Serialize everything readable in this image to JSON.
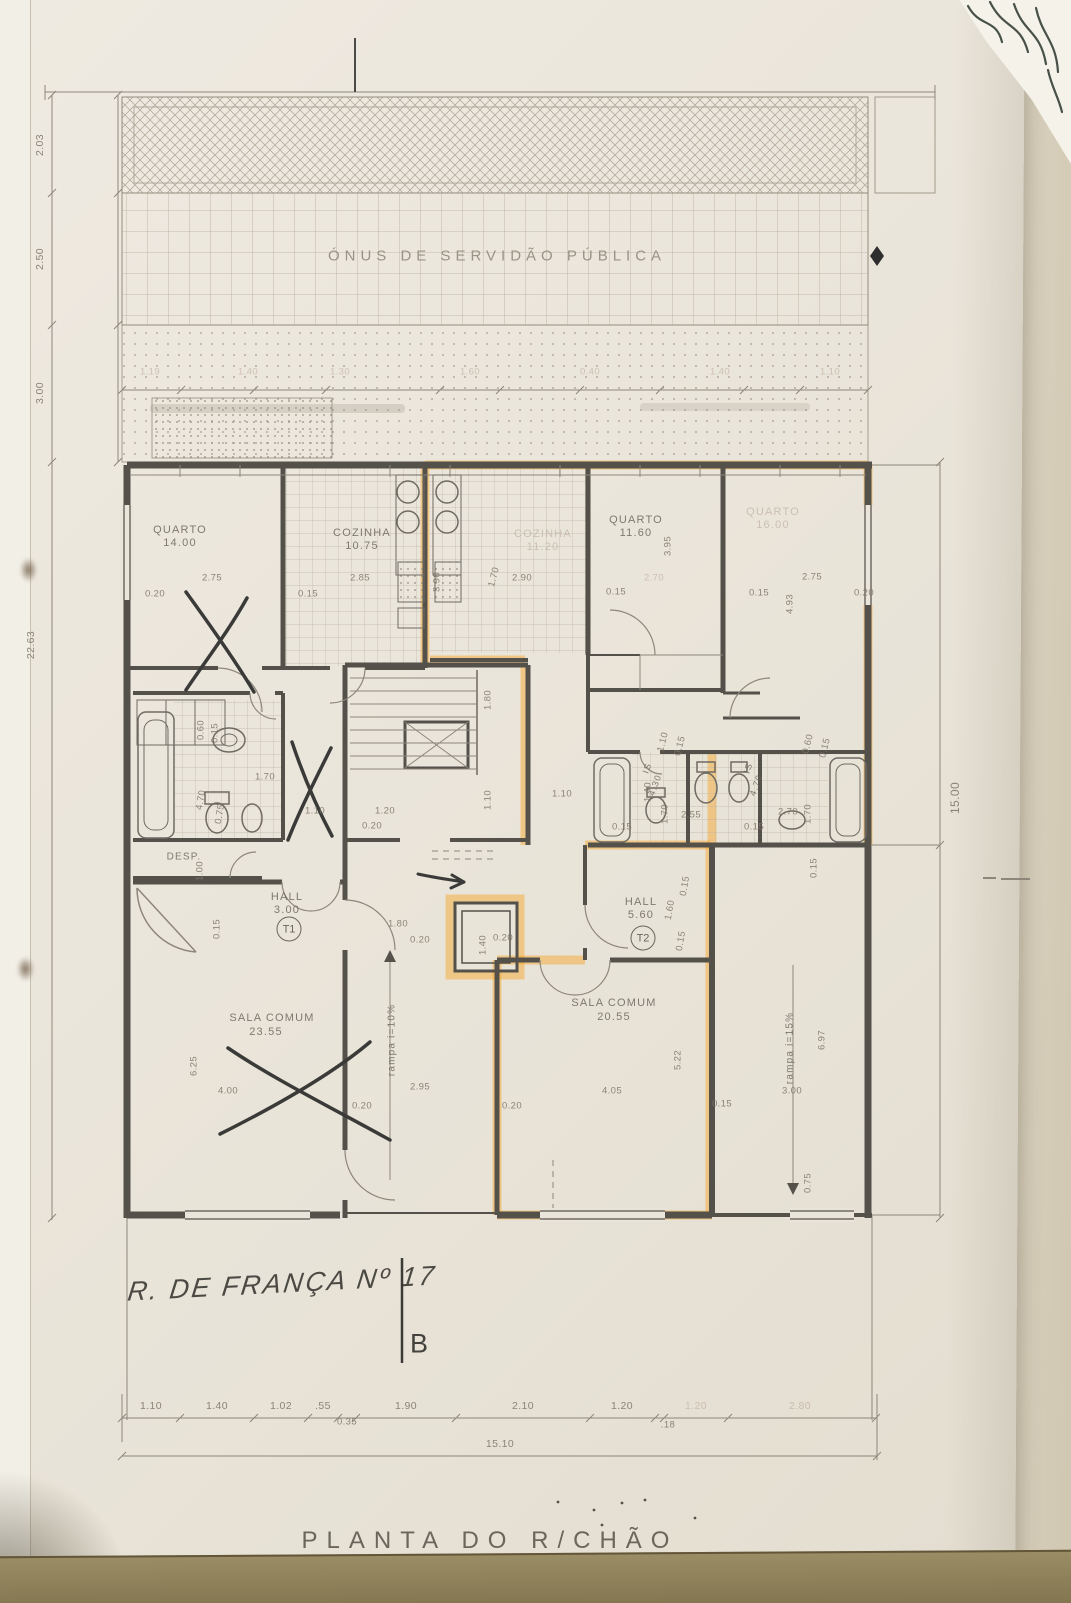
{
  "sheet": {
    "title": "PLANTA DO R/CHÃO",
    "easement_text": "ÓNUS DE SERVIDÃO PÚBLICA",
    "highlight_color": "#f2a731",
    "paper_color": "#eae5da",
    "table_color": "#8d7e59"
  },
  "handwriting": {
    "street": "R. DE FRANÇA Nº 17",
    "section_mark": "B"
  },
  "units": [
    {
      "tag": "T1"
    },
    {
      "tag": "T2"
    }
  ],
  "rooms": [
    {
      "name": "quarto-1",
      "label": "QUARTO",
      "area": "14.00"
    },
    {
      "name": "cozinha-1",
      "label": "COZINHA",
      "area": "10.75"
    },
    {
      "name": "cozinha-2",
      "label": "COZINHA",
      "area": "11.20"
    },
    {
      "name": "quarto-2",
      "label": "QUARTO",
      "area": "11.60"
    },
    {
      "name": "quarto-3",
      "label": "QUARTO",
      "area": "16.00"
    },
    {
      "name": "is-1",
      "label": "IS",
      "area": "4.30"
    },
    {
      "name": "is-2",
      "label": "IS",
      "area": "4.70"
    },
    {
      "name": "despensa",
      "label": "DESP."
    },
    {
      "name": "hall-t1",
      "label": "HALL",
      "area": "3.00"
    },
    {
      "name": "hall-t2",
      "label": "HALL",
      "area": "5.60"
    },
    {
      "name": "sala-comum-1",
      "label": "SALA COMUM",
      "area": "23.55"
    },
    {
      "name": "sala-comum-2",
      "label": "SALA COMUM",
      "area": "20.55"
    },
    {
      "name": "rampa-1",
      "label": "rampa i=10%"
    },
    {
      "name": "rampa-2",
      "label": "rampa i=15%"
    }
  ],
  "dimension_chains": {
    "left_vertical": [
      "2.03",
      "2.50",
      "3.00",
      "22.63"
    ],
    "right_vertical": [
      "15.00"
    ],
    "upper_row": [
      "1.19",
      "1.40",
      "1.30",
      "1.60",
      "0.40",
      "1.40",
      "1.10"
    ],
    "bottom_row": [
      "1.10",
      "1.40",
      "1.02",
      ".55",
      "1.90",
      "2.10",
      "1.20",
      "1.20",
      "2.80"
    ],
    "bottom_sub": [
      "0.35",
      ".18"
    ],
    "bottom_total": "15.10"
  },
  "labels": [
    {
      "n": "easement-text",
      "t": "ÓNUS DE SERVIDÃO PÚBLICA",
      "x": 497,
      "y": 256,
      "cls": "easement"
    },
    {
      "n": "room-quarto-1-label",
      "t": "QUARTO",
      "x": 180,
      "y": 530,
      "cls": "room"
    },
    {
      "n": "room-quarto-1-area",
      "t": "14.00",
      "x": 180,
      "y": 543,
      "cls": "room"
    },
    {
      "n": "room-cozinha-1-label",
      "t": "COZINHA",
      "x": 362,
      "y": 533,
      "cls": "room"
    },
    {
      "n": "room-cozinha-1-area",
      "t": "10.75",
      "x": 362,
      "y": 546,
      "cls": "room"
    },
    {
      "n": "room-cozinha-2-label",
      "t": "COZINHA",
      "x": 543,
      "y": 534,
      "cls": "room faint2"
    },
    {
      "n": "room-cozinha-2-area",
      "t": "11.20",
      "x": 543,
      "y": 547,
      "cls": "room faint2"
    },
    {
      "n": "room-quarto-2-label",
      "t": "QUARTO",
      "x": 636,
      "y": 520,
      "cls": "room"
    },
    {
      "n": "room-quarto-2-area",
      "t": "11.60",
      "x": 636,
      "y": 533,
      "cls": "room"
    },
    {
      "n": "room-quarto-3-label",
      "t": "QUARTO",
      "x": 773,
      "y": 512,
      "cls": "room faint2"
    },
    {
      "n": "room-quarto-3-area",
      "t": "16.00",
      "x": 773,
      "y": 525,
      "cls": "room faint2"
    },
    {
      "n": "room-desp-label",
      "t": "DESP.",
      "x": 184,
      "y": 857,
      "cls": "room",
      "fs": 10
    },
    {
      "n": "room-hall-t1-label",
      "t": "HALL",
      "x": 287,
      "y": 897,
      "cls": "room"
    },
    {
      "n": "room-hall-t1-area",
      "t": "3.00",
      "x": 287,
      "y": 910,
      "cls": "room"
    },
    {
      "n": "room-hall-t2-label",
      "t": "HALL",
      "x": 641,
      "y": 902,
      "cls": "room"
    },
    {
      "n": "room-hall-t2-area",
      "t": "5.60",
      "x": 641,
      "y": 915,
      "cls": "room"
    },
    {
      "n": "room-sala-1-label",
      "t": "SALA COMUM",
      "x": 272,
      "y": 1018,
      "cls": "room"
    },
    {
      "n": "room-sala-1-area",
      "t": "23.55",
      "x": 266,
      "y": 1032,
      "cls": "room"
    },
    {
      "n": "room-sala-2-label",
      "t": "SALA COMUM",
      "x": 614,
      "y": 1003,
      "cls": "room"
    },
    {
      "n": "room-sala-2-area",
      "t": "20.55",
      "x": 614,
      "y": 1017,
      "cls": "room"
    },
    {
      "n": "room-is-1-label",
      "t": "IS",
      "x": 647,
      "y": 768,
      "r": -70,
      "cls": "room",
      "fs": 9
    },
    {
      "n": "room-is-1-area",
      "t": "4.30",
      "x": 655,
      "y": 785,
      "r": -70,
      "cls": "room",
      "fs": 9
    },
    {
      "n": "room-is-2-label",
      "t": "IS",
      "x": 748,
      "y": 768,
      "r": -70,
      "cls": "room",
      "fs": 9
    },
    {
      "n": "room-is-2-area",
      "t": "4.70",
      "x": 756,
      "y": 785,
      "r": -70,
      "cls": "room",
      "fs": 9
    },
    {
      "n": "room-rampa-1-label",
      "t": "rampa i=10%",
      "x": 392,
      "y": 1040,
      "r": -90,
      "cls": "room",
      "fs": 10
    },
    {
      "n": "room-rampa-2-label",
      "t": "rampa i=15%",
      "x": 790,
      "y": 1048,
      "r": -90,
      "cls": "room",
      "fs": 10
    },
    {
      "n": "unit-t1-badge",
      "t": "T1",
      "x": 289,
      "y": 929,
      "cls": "unit"
    },
    {
      "n": "unit-t2-badge",
      "t": "T2",
      "x": 643,
      "y": 938,
      "cls": "unit"
    },
    {
      "n": "dim-left",
      "t": "2.03",
      "x": 40,
      "y": 145,
      "r": -90,
      "cls": "dim dimL"
    },
    {
      "n": "dim-left",
      "t": "2.50",
      "x": 40,
      "y": 259,
      "r": -90,
      "cls": "dim dimL"
    },
    {
      "n": "dim-left",
      "t": "3.00",
      "x": 40,
      "y": 393,
      "r": -90,
      "cls": "dim dimL"
    },
    {
      "n": "dim-left",
      "t": "22.63",
      "x": 31,
      "y": 645,
      "r": -90,
      "cls": "dim dimL"
    },
    {
      "n": "dim-right",
      "t": "15.00",
      "x": 955,
      "y": 798,
      "r": -90,
      "cls": "dim",
      "fs": 12
    },
    {
      "t": "1.19",
      "x": 150,
      "y": 372,
      "cls": "dim faint2"
    },
    {
      "t": "1.40",
      "x": 248,
      "y": 372,
      "cls": "dim faint2"
    },
    {
      "t": "1.30",
      "x": 340,
      "y": 372,
      "cls": "dim faint2"
    },
    {
      "t": "1.60",
      "x": 470,
      "y": 372,
      "cls": "dim faint2"
    },
    {
      "t": "0.40",
      "x": 590,
      "y": 372,
      "cls": "dim faint2"
    },
    {
      "t": "1.40",
      "x": 720,
      "y": 372,
      "cls": "dim faint2"
    },
    {
      "t": "1.10",
      "x": 830,
      "y": 372,
      "cls": "dim faint2"
    },
    {
      "t": "2.75",
      "x": 212,
      "y": 578,
      "cls": "dim"
    },
    {
      "t": "0.20",
      "x": 155,
      "y": 594,
      "cls": "dim"
    },
    {
      "t": "0.15",
      "x": 308,
      "y": 594,
      "cls": "dim"
    },
    {
      "t": "2.85",
      "x": 360,
      "y": 578,
      "cls": "dim"
    },
    {
      "t": "3.90",
      "x": 437,
      "y": 582,
      "r": -90,
      "cls": "dim"
    },
    {
      "t": "1.70",
      "x": 494,
      "y": 577,
      "r": -75,
      "cls": "dim"
    },
    {
      "t": "2.90",
      "x": 522,
      "y": 578,
      "cls": "dim"
    },
    {
      "t": "0.15",
      "x": 616,
      "y": 592,
      "cls": "dim"
    },
    {
      "t": "3.95",
      "x": 668,
      "y": 546,
      "r": -90,
      "cls": "dim"
    },
    {
      "t": "2.70",
      "x": 654,
      "y": 578,
      "cls": "dim faint2"
    },
    {
      "t": "2.75",
      "x": 812,
      "y": 577,
      "cls": "dim"
    },
    {
      "t": "0.15",
      "x": 759,
      "y": 593,
      "cls": "dim"
    },
    {
      "t": "0.20",
      "x": 864,
      "y": 593,
      "cls": "dim"
    },
    {
      "t": "4.93",
      "x": 790,
      "y": 604,
      "r": -90,
      "cls": "dim"
    },
    {
      "t": "0.60",
      "x": 201,
      "y": 730,
      "r": -90,
      "cls": "dim"
    },
    {
      "t": "0.15",
      "x": 215,
      "y": 733,
      "r": -90,
      "cls": "dim"
    },
    {
      "t": "1.70",
      "x": 265,
      "y": 777,
      "cls": "dim"
    },
    {
      "t": "4.70",
      "x": 201,
      "y": 800,
      "r": -80,
      "cls": "dim"
    },
    {
      "t": "0.75",
      "x": 220,
      "y": 814,
      "r": -80,
      "cls": "dim"
    },
    {
      "t": "1.00",
      "x": 200,
      "y": 871,
      "r": -90,
      "cls": "dim"
    },
    {
      "t": "0.15",
      "x": 217,
      "y": 929,
      "r": -90,
      "cls": "dim"
    },
    {
      "t": "1.80",
      "x": 488,
      "y": 700,
      "r": -90,
      "cls": "dim"
    },
    {
      "t": "1.10",
      "x": 488,
      "y": 800,
      "r": -90,
      "cls": "dim"
    },
    {
      "t": "1.10",
      "x": 315,
      "y": 811,
      "cls": "dim"
    },
    {
      "t": "1.20",
      "x": 385,
      "y": 811,
      "cls": "dim"
    },
    {
      "t": "0.20",
      "x": 372,
      "y": 826,
      "cls": "dim"
    },
    {
      "t": "1.10",
      "x": 562,
      "y": 794,
      "cls": "dim"
    },
    {
      "t": "1.80",
      "x": 398,
      "y": 924,
      "cls": "dim"
    },
    {
      "t": "0.20",
      "x": 420,
      "y": 940,
      "cls": "dim"
    },
    {
      "t": "1.40",
      "x": 483,
      "y": 945,
      "r": -90,
      "cls": "dim"
    },
    {
      "t": "0.20",
      "x": 503,
      "y": 938,
      "cls": "dim"
    },
    {
      "t": "1.10",
      "x": 663,
      "y": 742,
      "r": -75,
      "cls": "dim"
    },
    {
      "t": "0.15",
      "x": 680,
      "y": 746,
      "r": -75,
      "cls": "dim"
    },
    {
      "t": "0.60",
      "x": 808,
      "y": 744,
      "r": -75,
      "cls": "dim"
    },
    {
      "t": "0.15",
      "x": 825,
      "y": 748,
      "r": -75,
      "cls": "dim"
    },
    {
      "t": "1.40",
      "x": 648,
      "y": 792,
      "r": -90,
      "cls": "dim"
    },
    {
      "t": "1.70",
      "x": 665,
      "y": 814,
      "r": -90,
      "cls": "dim"
    },
    {
      "t": "2.55",
      "x": 691,
      "y": 815,
      "cls": "dim"
    },
    {
      "t": "0.15",
      "x": 622,
      "y": 827,
      "cls": "dim"
    },
    {
      "t": "2.70",
      "x": 788,
      "y": 812,
      "cls": "dim"
    },
    {
      "t": "1.70",
      "x": 808,
      "y": 814,
      "r": -90,
      "cls": "dim"
    },
    {
      "t": "0.15",
      "x": 754,
      "y": 827,
      "cls": "dim"
    },
    {
      "t": "1.60",
      "x": 670,
      "y": 910,
      "r": -80,
      "cls": "dim"
    },
    {
      "t": "0.15",
      "x": 685,
      "y": 886,
      "r": -80,
      "cls": "dim"
    },
    {
      "t": "0.15",
      "x": 681,
      "y": 941,
      "r": -80,
      "cls": "dim"
    },
    {
      "t": "6.25",
      "x": 194,
      "y": 1066,
      "r": -90,
      "cls": "dim"
    },
    {
      "t": "4.00",
      "x": 228,
      "y": 1091,
      "cls": "dim"
    },
    {
      "t": "2.95",
      "x": 420,
      "y": 1087,
      "cls": "dim"
    },
    {
      "t": "0.20",
      "x": 362,
      "y": 1106,
      "cls": "dim"
    },
    {
      "t": "0.20",
      "x": 512,
      "y": 1106,
      "cls": "dim"
    },
    {
      "t": "4.05",
      "x": 612,
      "y": 1091,
      "cls": "dim"
    },
    {
      "t": "5.22",
      "x": 678,
      "y": 1060,
      "r": -90,
      "cls": "dim"
    },
    {
      "t": "0.15",
      "x": 722,
      "y": 1104,
      "cls": "dim"
    },
    {
      "t": "3.00",
      "x": 792,
      "y": 1091,
      "cls": "dim"
    },
    {
      "t": "6.97",
      "x": 822,
      "y": 1040,
      "r": -90,
      "cls": "dim"
    },
    {
      "t": "0.75",
      "x": 808,
      "y": 1183,
      "r": -90,
      "cls": "dim"
    },
    {
      "t": "0.15",
      "x": 814,
      "y": 868,
      "r": -90,
      "cls": "dim"
    },
    {
      "n": "dim-bottom",
      "t": "1.10",
      "x": 151,
      "y": 1406,
      "cls": "dim dimL"
    },
    {
      "n": "dim-bottom",
      "t": "1.40",
      "x": 217,
      "y": 1406,
      "cls": "dim dimL"
    },
    {
      "n": "dim-bottom",
      "t": "1.02",
      "x": 281,
      "y": 1406,
      "cls": "dim dimL"
    },
    {
      "n": "dim-bottom",
      "t": ".55",
      "x": 323,
      "y": 1406,
      "cls": "dim dimL"
    },
    {
      "n": "dim-bottom",
      "t": "1.90",
      "x": 406,
      "y": 1406,
      "cls": "dim dimL"
    },
    {
      "n": "dim-bottom",
      "t": "2.10",
      "x": 523,
      "y": 1406,
      "cls": "dim dimL"
    },
    {
      "n": "dim-bottom",
      "t": "1.20",
      "x": 622,
      "y": 1406,
      "cls": "dim dimL"
    },
    {
      "n": "dim-bottom",
      "t": "1.20",
      "x": 696,
      "y": 1406,
      "cls": "dim dimL faint2"
    },
    {
      "n": "dim-bottom",
      "t": "2.80",
      "x": 800,
      "y": 1406,
      "cls": "dim dimL faint2"
    },
    {
      "n": "dim-bottom",
      "t": "0.35",
      "x": 347,
      "y": 1422,
      "cls": "dim"
    },
    {
      "n": "dim-bottom",
      "t": ".18",
      "x": 668,
      "y": 1425,
      "cls": "dim"
    },
    {
      "n": "dim-bottom-total",
      "t": "15.10",
      "x": 500,
      "y": 1444,
      "cls": "dim dimL"
    },
    {
      "n": "handwritten-street",
      "t": "R. DE FRANÇA Nº 17",
      "x": 282,
      "y": 1284,
      "r": -3,
      "cls": "hand"
    },
    {
      "n": "section-mark-letter",
      "t": "B",
      "x": 419,
      "y": 1344,
      "cls": "sectionB"
    },
    {
      "n": "sheet-title",
      "t": "PLANTA DO R/CHÃO",
      "x": 490,
      "y": 1541,
      "cls": "title"
    }
  ]
}
